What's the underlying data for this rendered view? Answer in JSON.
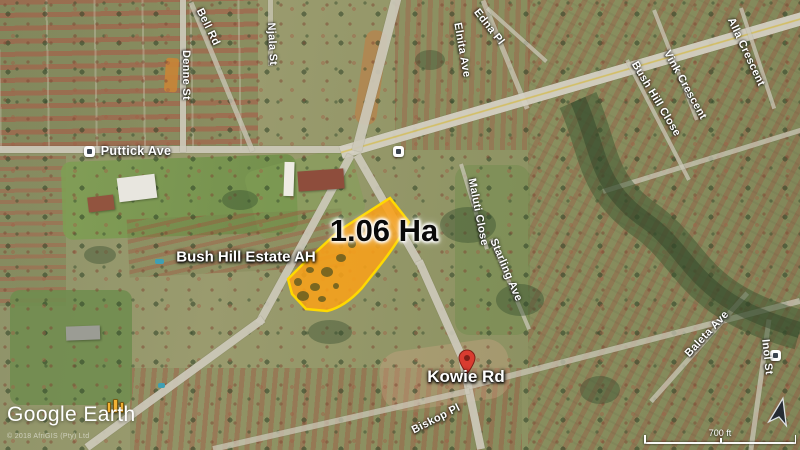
{
  "map": {
    "watermark": "Google Earth",
    "attribution": "© 2018 AfriGIS (Pty) Ltd",
    "area_overlay": {
      "label": "1.06 Ha",
      "fill": "#F8A019",
      "border": "#FFD900"
    },
    "place_labels": {
      "estate": "Bush Hill Estate AH",
      "pin_street": "Kowie Rd"
    },
    "street_labels": [
      {
        "text": "Denne St",
        "x": 186,
        "y": 75,
        "rot": 90,
        "fs": 11
      },
      {
        "text": "Bell Rd",
        "x": 208,
        "y": 27,
        "rot": 64,
        "fs": 11
      },
      {
        "text": "Puttick Ave",
        "x": 136,
        "y": 151,
        "rot": 0,
        "fs": 12.5
      },
      {
        "text": "Njala St",
        "x": 272,
        "y": 44,
        "rot": 87,
        "fs": 11
      },
      {
        "text": "Edna Pl",
        "x": 489,
        "y": 27,
        "rot": 52,
        "fs": 11
      },
      {
        "text": "Elnita Ave",
        "x": 462,
        "y": 50,
        "rot": 80,
        "fs": 11
      },
      {
        "text": "Vink Crescent",
        "x": 685,
        "y": 85,
        "rot": 61,
        "fs": 11
      },
      {
        "text": "Bush Hill Close",
        "x": 656,
        "y": 99,
        "rot": 59,
        "fs": 11
      },
      {
        "text": "Alla Crescent",
        "x": 746,
        "y": 52,
        "rot": 65,
        "fs": 11
      },
      {
        "text": "Maluti Close",
        "x": 478,
        "y": 212,
        "rot": 79,
        "fs": 11
      },
      {
        "text": "Starling Ave",
        "x": 506,
        "y": 270,
        "rot": 67,
        "fs": 11
      },
      {
        "text": "Baleta Ave",
        "x": 707,
        "y": 334,
        "rot": -47,
        "fs": 11
      },
      {
        "text": "Inol St",
        "x": 767,
        "y": 357,
        "rot": 84,
        "fs": 11
      },
      {
        "text": "Biskop Pl",
        "x": 436,
        "y": 419,
        "rot": -27,
        "fs": 11
      }
    ],
    "scale_bar": {
      "label": "700 ft"
    },
    "icons": {
      "pin": "red-map-pin",
      "traffic": "traffic-light-icon",
      "poi": "white-poi-box-icon",
      "compass": "north-arrow-icon"
    },
    "colors": {
      "pin_red": "#D93C30",
      "road": "#CDC9BA",
      "label_white": "#FFFFFF"
    }
  }
}
